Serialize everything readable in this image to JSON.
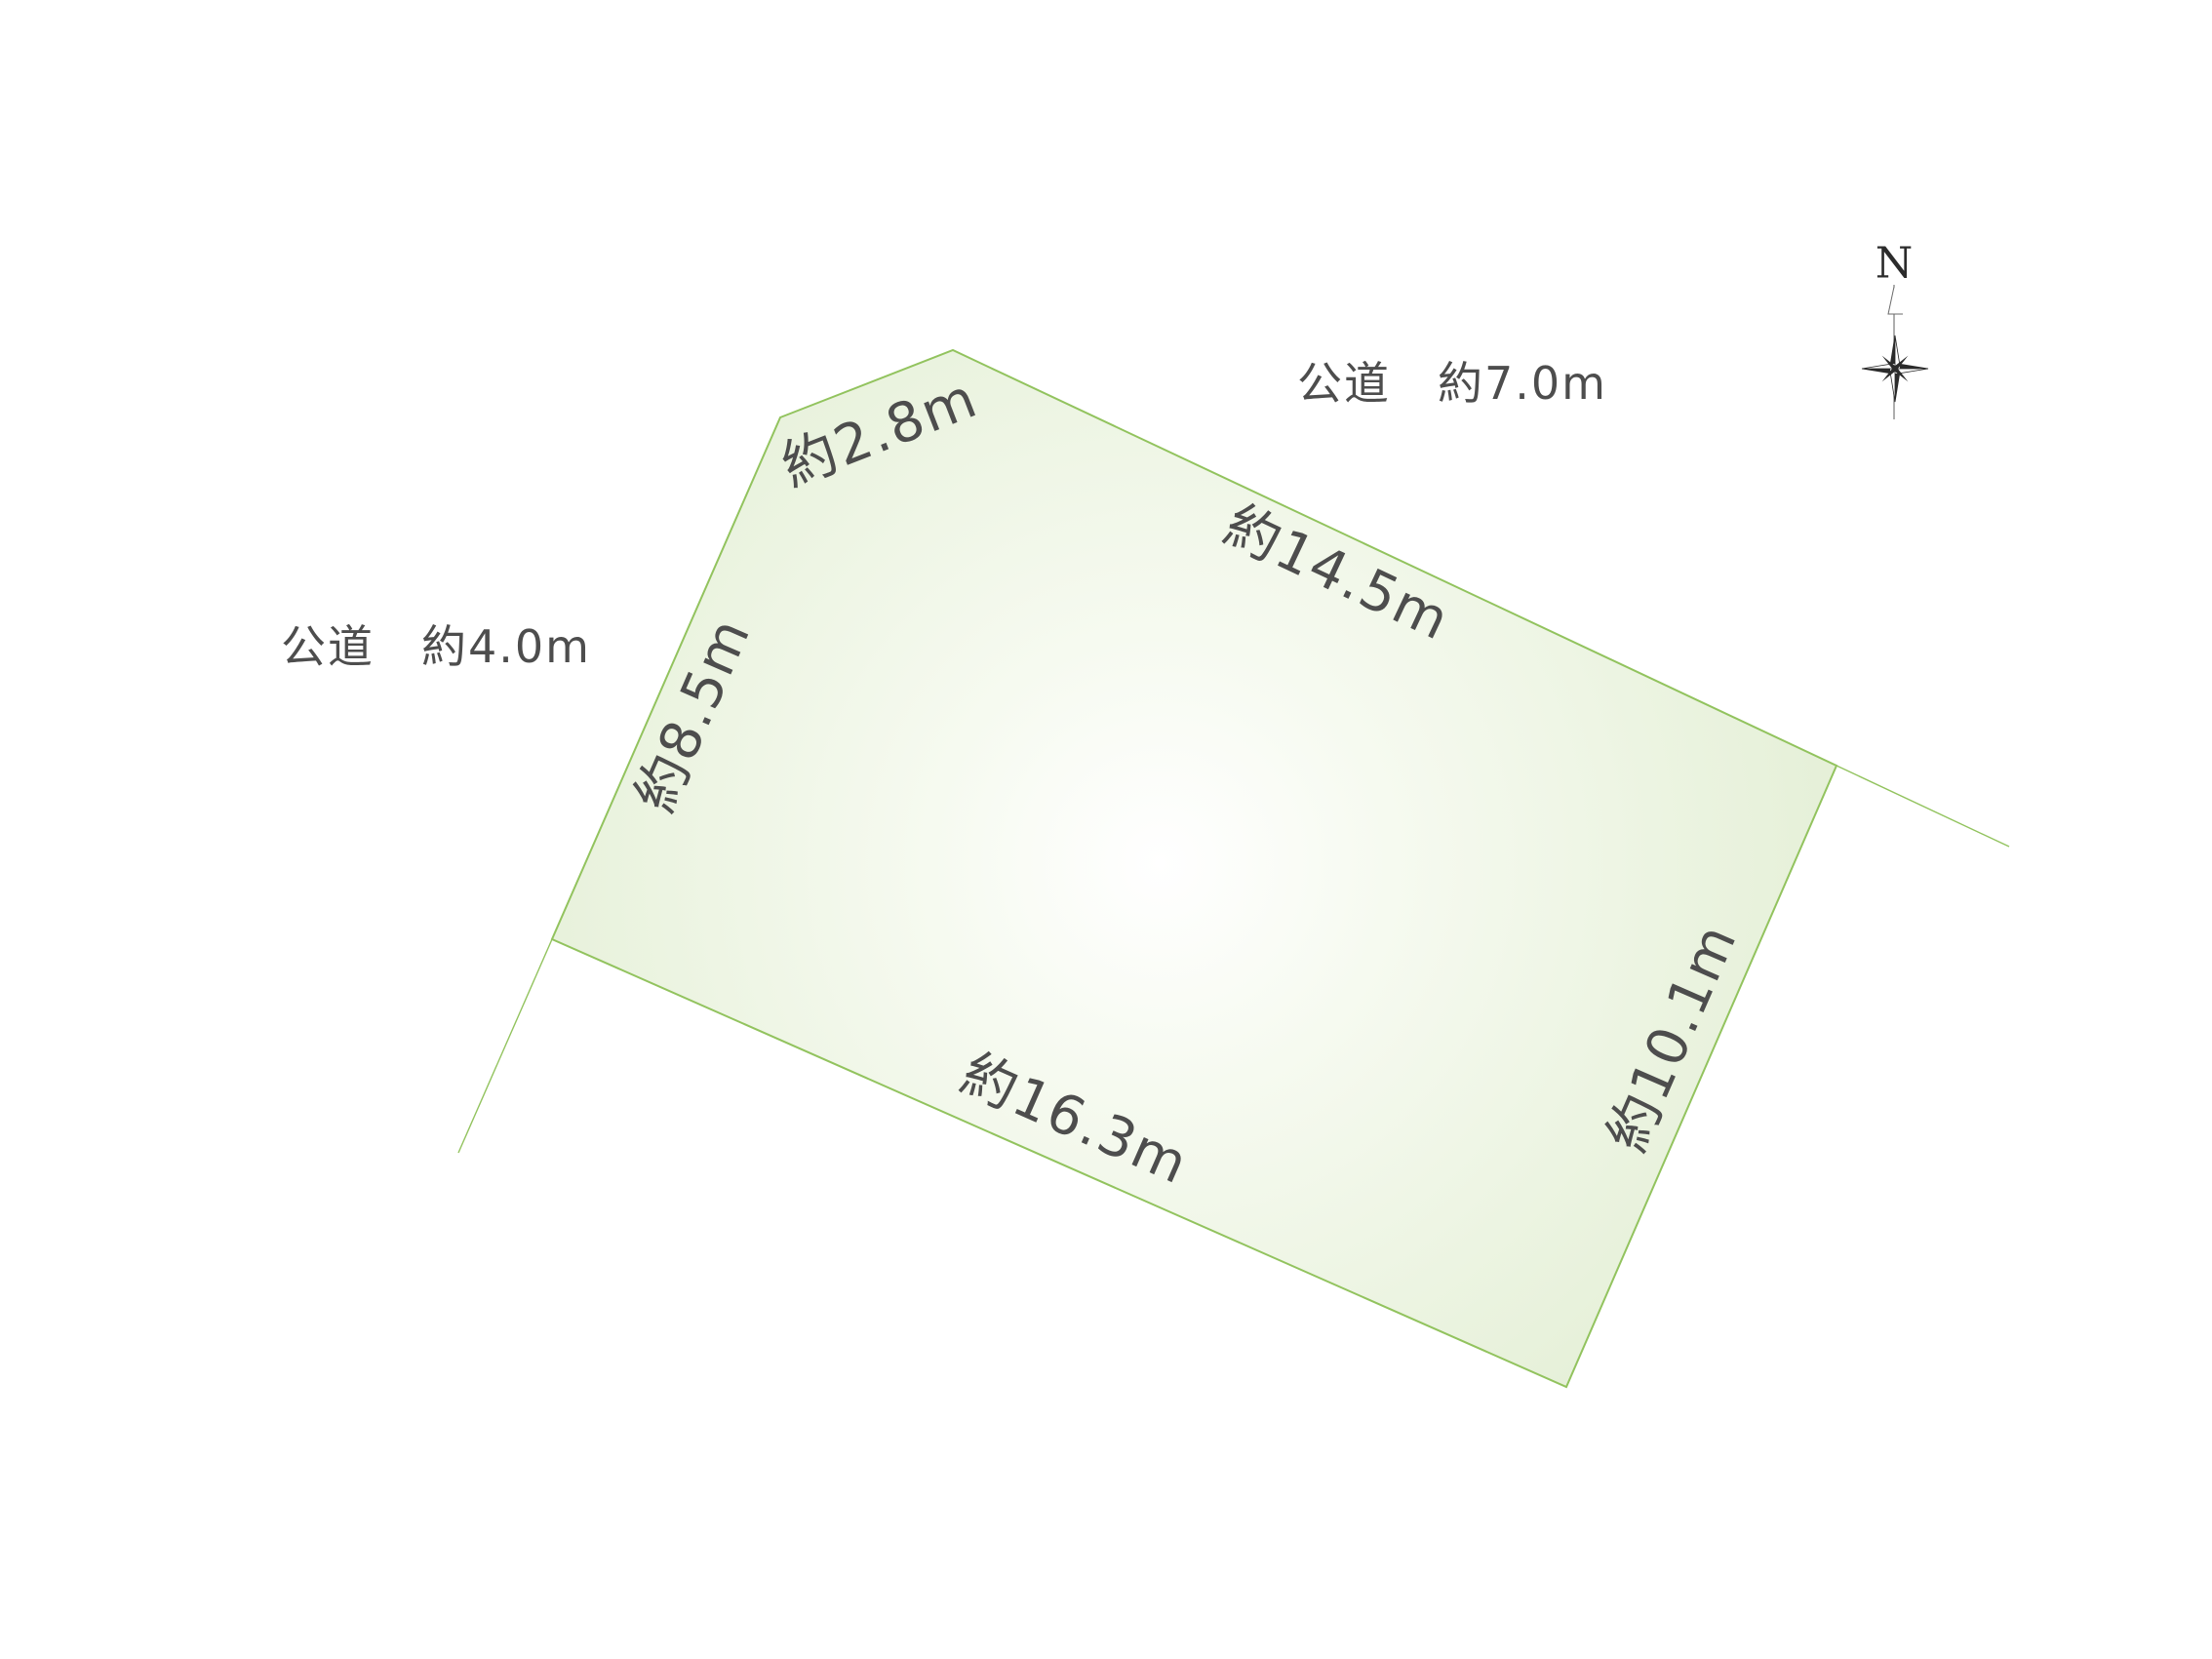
{
  "page": {
    "background": "#ffffff"
  },
  "parcel": {
    "shape": "pentagon",
    "fill_center": "#ffffff",
    "fill_mid": "#f6faf0",
    "fill_edge": "#e2eed3",
    "stroke": "#92c35e",
    "dimensions": {
      "corner_cut": "約2.8m",
      "north_edge": "約14.5m",
      "west_edge": "約8.5m",
      "south_edge": "約16.3m",
      "east_edge": "約10.1m"
    }
  },
  "roads": {
    "north": "公道　約7.0m",
    "west": "公道　約4.0m"
  },
  "compass": {
    "north_label": "N",
    "color": "#2b2b2b"
  },
  "text_color": "#4d4d4d"
}
